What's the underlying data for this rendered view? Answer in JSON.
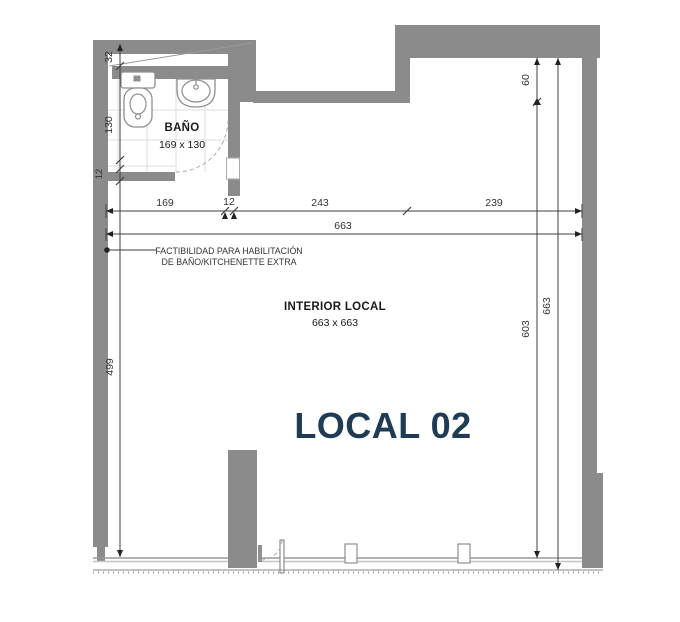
{
  "plan": {
    "title": "LOCAL 02",
    "interior": {
      "label": "INTERIOR LOCAL",
      "size": "663 x 663"
    },
    "bathroom": {
      "label": "BAÑO",
      "size": "169 x 130"
    },
    "note": {
      "line1": "FACTIBILIDAD PARA HABILITACIÓN",
      "line2": "DE BAÑO/KITCHENETTE EXTRA"
    },
    "dims": {
      "top": {
        "segments": [
          "169",
          "12",
          "243",
          "239"
        ],
        "total": "663"
      },
      "left": {
        "bath": [
          "32",
          "130",
          "12"
        ],
        "main": "499"
      },
      "right": {
        "top": "60",
        "inner": "603",
        "total": "663"
      }
    },
    "colors": {
      "wall": "#8b8b8b",
      "accent": "#1e3c55",
      "line": "#3f3f3f"
    }
  }
}
